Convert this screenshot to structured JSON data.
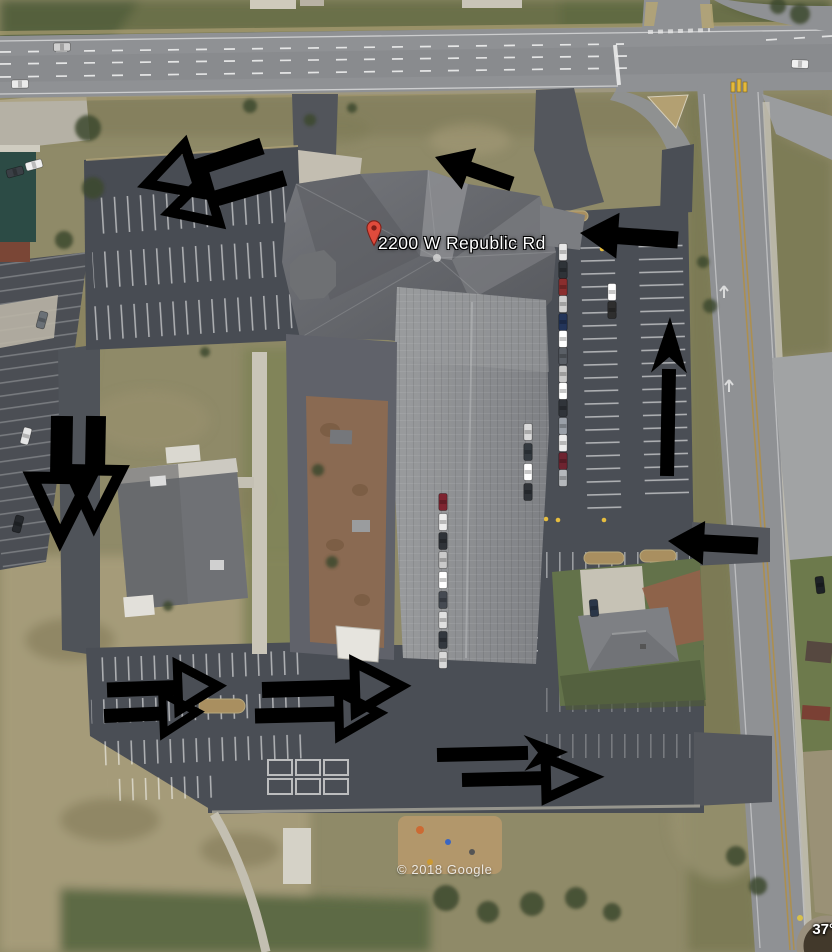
{
  "map": {
    "address_label": "2200 W Republic Rd",
    "attribution": "© 2018 Google",
    "coordinate_fragment": "37°",
    "colors": {
      "pin_red": "#e04b3c",
      "pin_dark": "#7e1f18",
      "arrow": "#000000",
      "label_text": "#ffffff"
    }
  },
  "annotations": {
    "arrows": [
      {
        "id": "nw-lot-upper",
        "direction": "down-left",
        "style": "open",
        "tail": [
          262,
          146
        ],
        "tip": [
          147,
          184
        ],
        "shaft": 17,
        "head_len": 48,
        "head_w": 52,
        "stroke": 10
      },
      {
        "id": "nw-lot-lower",
        "direction": "down-left",
        "style": "open",
        "tail": [
          285,
          178
        ],
        "tip": [
          170,
          212
        ],
        "shaft": 16,
        "head_len": 44,
        "head_w": 48,
        "stroke": 10
      },
      {
        "id": "front-drive-west",
        "direction": "up-left",
        "style": "solid",
        "tail": [
          512,
          184
        ],
        "tip": [
          435,
          157
        ],
        "shaft": 15,
        "head_len": 36,
        "head_w": 44
      },
      {
        "id": "east-lot-entry",
        "direction": "left",
        "style": "solid",
        "tail": [
          678,
          240
        ],
        "tip": [
          580,
          233
        ],
        "shaft": 17,
        "head_len": 38,
        "head_w": 46
      },
      {
        "id": "east-lot-exit-lane",
        "direction": "up",
        "style": "notched",
        "notch": 16,
        "tail": [
          667,
          476
        ],
        "tip": [
          670,
          317
        ],
        "shaft": 14,
        "head_len": 56,
        "head_w": 36
      },
      {
        "id": "east-driveway-entry",
        "direction": "left",
        "style": "solid",
        "tail": [
          758,
          546
        ],
        "tip": [
          668,
          541
        ],
        "shaft": 17,
        "head_len": 36,
        "head_w": 44
      },
      {
        "id": "west-drive-down-left",
        "direction": "down",
        "style": "open",
        "tail": [
          62,
          416
        ],
        "tip": [
          60,
          538
        ],
        "shaft": 22,
        "head_len": 60,
        "head_w": 58,
        "stroke": 12
      },
      {
        "id": "west-drive-down-right",
        "direction": "down",
        "style": "open",
        "tail": [
          96,
          416
        ],
        "tip": [
          94,
          524
        ],
        "shaft": 20,
        "head_len": 54,
        "head_w": 52,
        "stroke": 11
      },
      {
        "id": "south-lot-west-upper",
        "direction": "right",
        "style": "open",
        "tail": [
          107,
          690
        ],
        "tip": [
          218,
          686
        ],
        "shaft": 15,
        "head_len": 40,
        "head_w": 46,
        "stroke": 9
      },
      {
        "id": "south-lot-west-lower",
        "direction": "right",
        "style": "open",
        "tail": [
          104,
          716
        ],
        "tip": [
          197,
          712
        ],
        "shaft": 14,
        "head_len": 34,
        "head_w": 40,
        "stroke": 8
      },
      {
        "id": "south-lot-mid-upper",
        "direction": "right",
        "style": "open",
        "tail": [
          262,
          690
        ],
        "tip": [
          401,
          686
        ],
        "shaft": 16,
        "head_len": 46,
        "head_w": 50,
        "stroke": 10
      },
      {
        "id": "south-lot-mid-lower",
        "direction": "right",
        "style": "open",
        "tail": [
          255,
          716
        ],
        "tip": [
          379,
          713
        ],
        "shaft": 15,
        "head_len": 40,
        "head_w": 44,
        "stroke": 9
      },
      {
        "id": "south-exit-upper",
        "direction": "right",
        "style": "notched",
        "notch": 14,
        "tail": [
          437,
          755
        ],
        "tip": [
          568,
          752
        ],
        "shaft": 14,
        "head_len": 44,
        "head_w": 36
      },
      {
        "id": "south-exit-lower",
        "direction": "right",
        "style": "open",
        "tail": [
          462,
          780
        ],
        "tip": [
          592,
          777
        ],
        "shaft": 14,
        "head_len": 46,
        "head_w": 40,
        "stroke": 10
      }
    ]
  },
  "scene": {
    "vehicles": [
      [
        563,
        252,
        90,
        "#e8e8e8"
      ],
      [
        563,
        270,
        90,
        "#2e3338"
      ],
      [
        563,
        287,
        90,
        "#8a2e2e"
      ],
      [
        563,
        304,
        90,
        "#cfcfcf"
      ],
      [
        563,
        322,
        90,
        "#23355a"
      ],
      [
        563,
        339,
        90,
        "#ffffff"
      ],
      [
        563,
        356,
        90,
        "#5a5f66"
      ],
      [
        563,
        374,
        90,
        "#c9c9c9"
      ],
      [
        563,
        391,
        90,
        "#ffffff"
      ],
      [
        563,
        408,
        90,
        "#30343a"
      ],
      [
        563,
        426,
        90,
        "#9aa0a8"
      ],
      [
        563,
        443,
        90,
        "#ececec"
      ],
      [
        563,
        461,
        90,
        "#6e2430"
      ],
      [
        563,
        478,
        90,
        "#b5b8bc"
      ],
      [
        528,
        432,
        90,
        "#d9d9d9"
      ],
      [
        528,
        452,
        90,
        "#343a40"
      ],
      [
        528,
        472,
        90,
        "#ffffff"
      ],
      [
        528,
        492,
        90,
        "#2f3338"
      ],
      [
        612,
        292,
        90,
        "#ffffff"
      ],
      [
        612,
        310,
        90,
        "#2e2e2e"
      ],
      [
        443,
        502,
        90,
        "#7e2430"
      ],
      [
        443,
        522,
        90,
        "#ececec"
      ],
      [
        443,
        541,
        90,
        "#2f3338"
      ],
      [
        443,
        560,
        90,
        "#c9c9c9"
      ],
      [
        443,
        580,
        90,
        "#ffffff"
      ],
      [
        443,
        600,
        90,
        "#454a52"
      ],
      [
        443,
        620,
        90,
        "#e0e0e0"
      ],
      [
        443,
        640,
        90,
        "#33383f"
      ],
      [
        443,
        660,
        90,
        "#d8d8d8"
      ],
      [
        26,
        436,
        -75,
        "#e5e5e5"
      ],
      [
        18,
        524,
        -75,
        "#25282c"
      ],
      [
        42,
        320,
        -75,
        "#6a7076"
      ],
      [
        34,
        165,
        -15,
        "#f0f0f0"
      ],
      [
        15,
        172,
        -15,
        "#3a3f45"
      ],
      [
        62,
        47,
        -1,
        "#cfcfcf"
      ],
      [
        20,
        84,
        -1,
        "#ebebeb"
      ],
      [
        800,
        64,
        3,
        "#f0f0f0"
      ],
      [
        820,
        585,
        83,
        "#1e2226"
      ],
      [
        594,
        608,
        85,
        "#2a3648"
      ]
    ],
    "trees": [
      [
        88,
        128,
        13
      ],
      [
        93,
        188,
        11
      ],
      [
        64,
        240,
        9
      ],
      [
        250,
        106,
        7
      ],
      [
        310,
        120,
        6
      ],
      [
        352,
        108,
        5
      ],
      [
        703,
        262,
        6
      ],
      [
        710,
        306,
        7
      ],
      [
        800,
        14,
        10
      ],
      [
        778,
        6,
        8
      ],
      [
        318,
        470,
        6
      ],
      [
        332,
        562,
        6
      ],
      [
        446,
        898,
        13
      ],
      [
        488,
        912,
        11
      ],
      [
        532,
        904,
        12
      ],
      [
        576,
        898,
        11
      ],
      [
        612,
        912,
        9
      ],
      [
        736,
        856,
        10
      ],
      [
        758,
        886,
        9
      ],
      [
        168,
        606,
        5
      ],
      [
        205,
        352,
        5
      ]
    ],
    "islands": [
      [
        430,
        546,
        42,
        13
      ],
      [
        497,
        550,
        40,
        13
      ],
      [
        428,
        618,
        40,
        13
      ],
      [
        492,
        652,
        42,
        13
      ],
      [
        222,
        706,
        46,
        14
      ],
      [
        480,
        506,
        44,
        12
      ],
      [
        604,
        558,
        40,
        12
      ],
      [
        658,
        556,
        36,
        12
      ],
      [
        560,
        216,
        56,
        10
      ]
    ]
  }
}
